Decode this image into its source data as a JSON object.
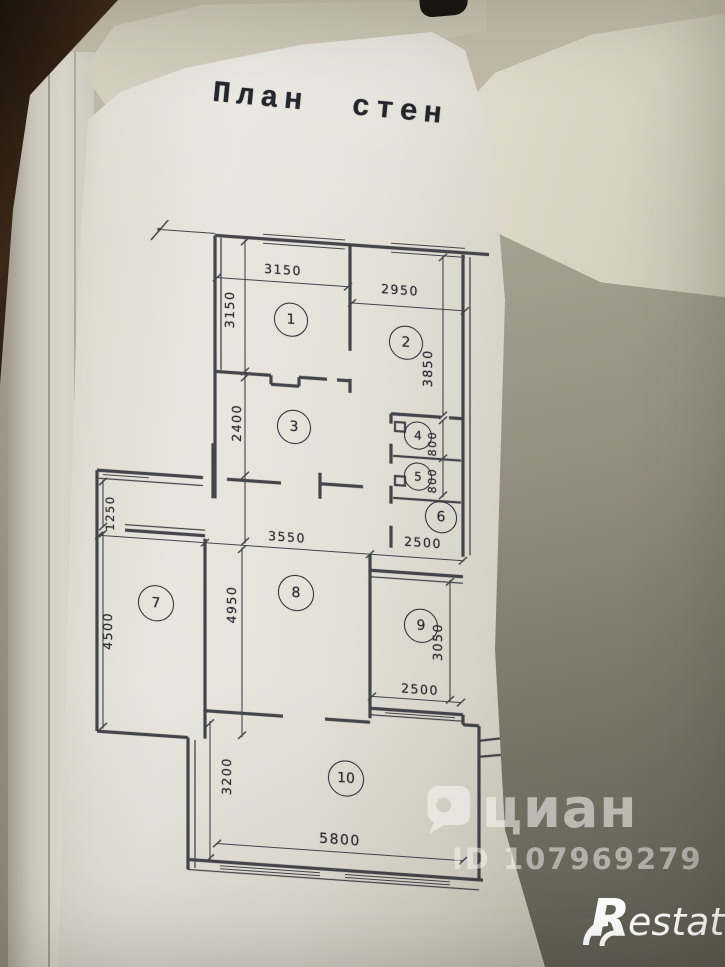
{
  "title": "План стен",
  "plan": {
    "rooms": [
      {
        "number": "1"
      },
      {
        "number": "2"
      },
      {
        "number": "3"
      },
      {
        "number": "4"
      },
      {
        "number": "5"
      },
      {
        "number": "6"
      },
      {
        "number": "7"
      },
      {
        "number": "8"
      },
      {
        "number": "9"
      },
      {
        "number": "10"
      }
    ],
    "dimensions": [
      {
        "value": "3150"
      },
      {
        "value": "2950"
      },
      {
        "value": "3150"
      },
      {
        "value": "3850"
      },
      {
        "value": "2400"
      },
      {
        "value": "800"
      },
      {
        "value": "800"
      },
      {
        "value": "1250"
      },
      {
        "value": "3550"
      },
      {
        "value": "2500"
      },
      {
        "value": "4500"
      },
      {
        "value": "4950"
      },
      {
        "value": "3050"
      },
      {
        "value": "2500"
      },
      {
        "value": "3200"
      },
      {
        "value": "5800"
      }
    ]
  },
  "watermark": {
    "brand": "циан",
    "listing_id": "ID 107969279"
  },
  "footer": {
    "brand_r": "R",
    "brand_rest": "estate"
  }
}
